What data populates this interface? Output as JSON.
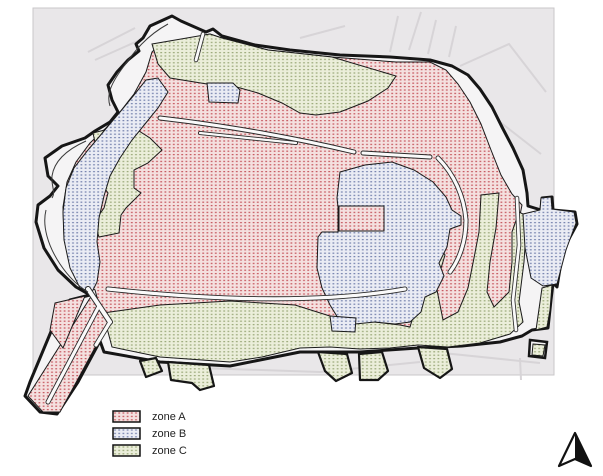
{
  "figure": {
    "type": "historic-walled-town-zoning-map",
    "background": "#ffffff"
  },
  "map": {
    "base_color": "#e9e7e9",
    "moat_color": "#f5f4f5",
    "wall_color": "#161616",
    "street_color": "#fafafa",
    "zones": [
      {
        "id": "A",
        "label": "zone A",
        "base": "#f4e0df",
        "dot": "#c5545c"
      },
      {
        "id": "B",
        "label": "zone B",
        "base": "#eaecf4",
        "dot": "#7380ac"
      },
      {
        "id": "C",
        "label": "zone C",
        "base": "#ebeeda",
        "dot": "#9aa878"
      }
    ]
  },
  "legend": {
    "items": [
      {
        "label": "zone A"
      },
      {
        "label": "zone B"
      },
      {
        "label": "zone C"
      }
    ]
  },
  "compass": {
    "name": "north-arrow"
  }
}
